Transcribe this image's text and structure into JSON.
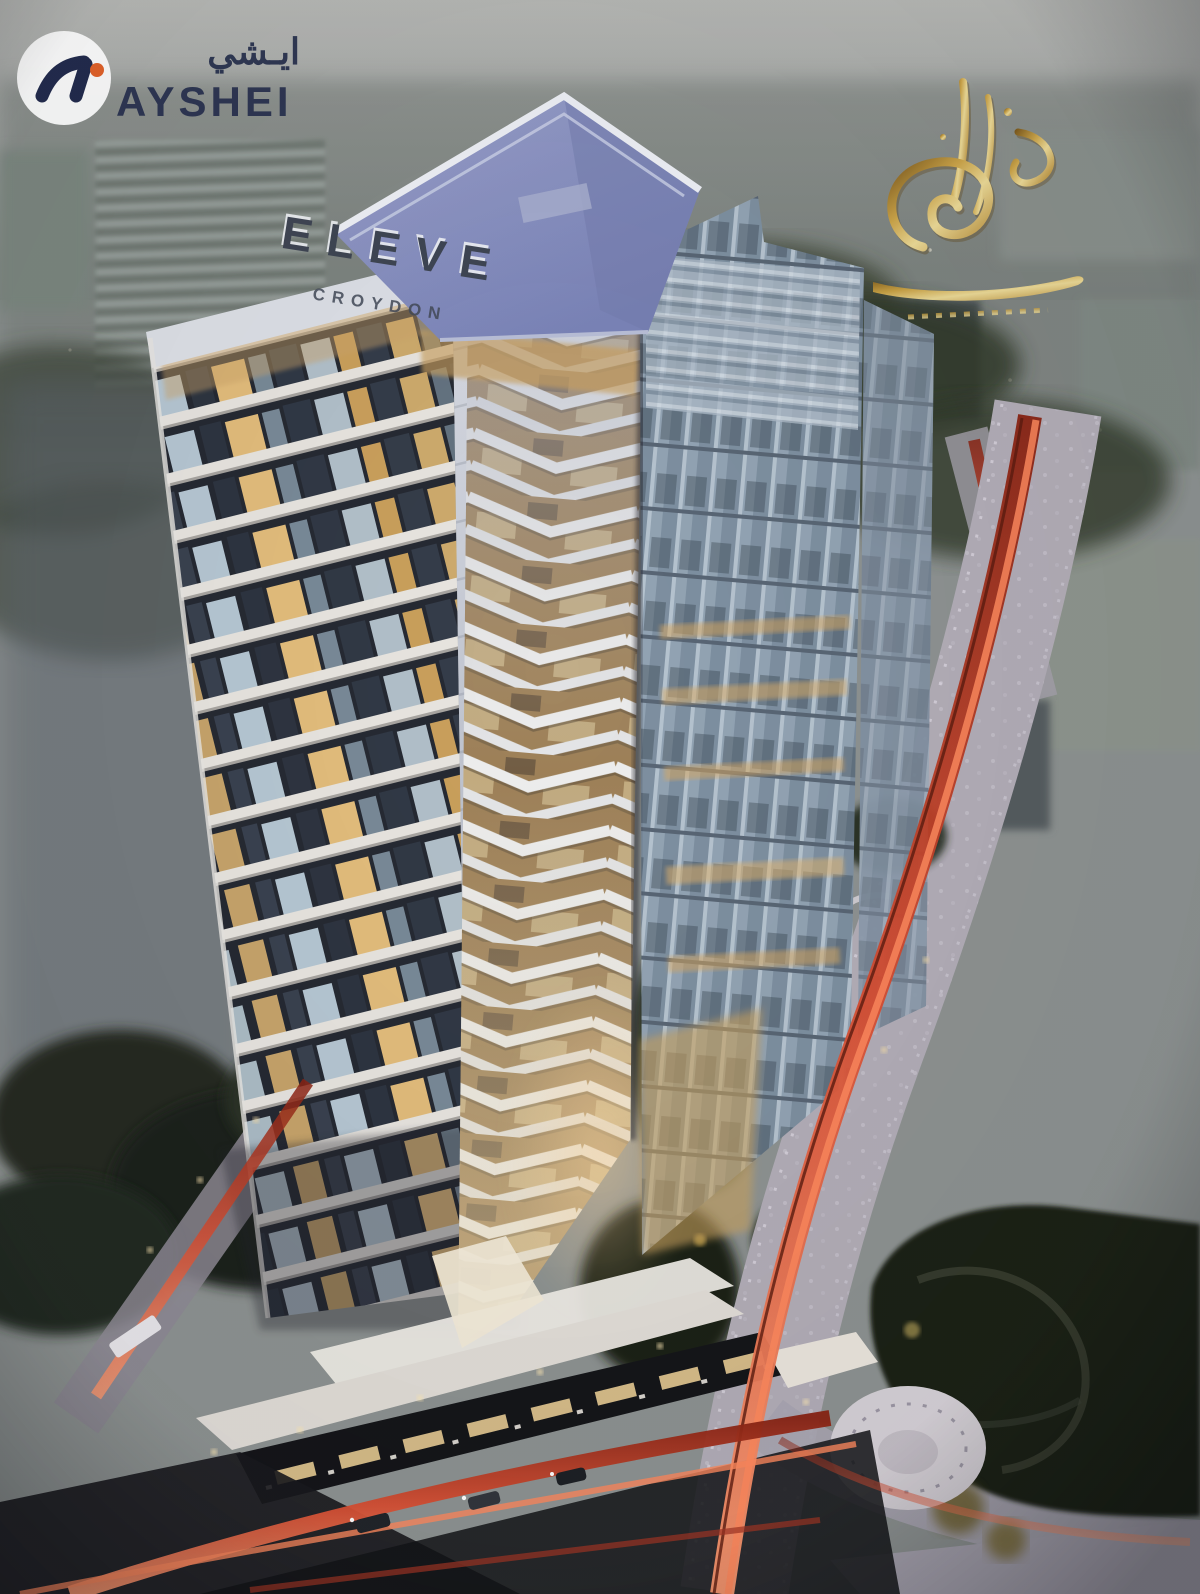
{
  "image": {
    "type": "architectural-rendering-photo",
    "scene": "Aerial dusk view of the ELEVE twin-tower residential development: white balconied tower, chevron-fin prow facade, glass tower, retail podium, curved highway with red traffic light trails, and dark parkland",
    "time_of_day": "dusk"
  },
  "watermarks": {
    "ayshei": {
      "brand": "AYSHEI",
      "arabic": "ايـشي",
      "mark": "circular white badge with navy numeral mark and orange dot"
    },
    "gold_calligraphy": {
      "description": "ornate gold Arabic calligraphy developer logo with swirl and flourish underline"
    }
  },
  "building": {
    "roof_sign": {
      "title": "ELEVE",
      "subtitle": "CROYDON"
    }
  },
  "palette": {
    "navy": "#243054",
    "orange": "#e2622b",
    "gold": "#c79a3e",
    "trail_red": "#b0341f",
    "trail_bright": "#ff8a5e",
    "sign_dark": "#3f4654",
    "roof_lavender": "#8b93c2",
    "warm_light": "#d9b271",
    "cool_light": "#cfe3ef",
    "road_grey": "#b3aeb8",
    "park_green": "#1b2318",
    "sky_grey": "#9b9ea0"
  }
}
